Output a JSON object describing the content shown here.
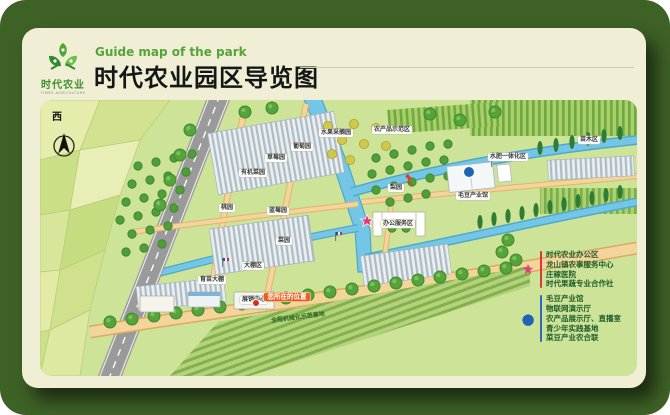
{
  "header": {
    "logo_name": "时代农业",
    "logo_sub": "TIMES AGRICULTURE",
    "subtitle": "Guide map of the park",
    "title": "时代农业园区导览图"
  },
  "compass": {
    "direction": "西"
  },
  "legend": {
    "star_items": [
      "时代农业办公区",
      "龙山镇农事服务中心",
      "庄稼医院",
      "时代果蔬专业合作社"
    ],
    "dot_items": [
      "毛豆产业馆",
      "物联网演示厅",
      "农产品展示厅、直播室",
      "青少年实践基地",
      "菜豆产业农合联"
    ]
  },
  "map": {
    "you_are_here": "您所在的位置",
    "labels": {
      "grape": "葡萄园",
      "strawberry": "草莓园",
      "organic_veg": "有机菜园",
      "fruit_picking": "水果采摘园",
      "demo_zone": "农产品示范区",
      "peach": "桃园",
      "blueberry": "蓝莓园",
      "vegetable": "菜园",
      "greenhouse": "大棚区",
      "pear": "梨园",
      "water_fert": "水肥一体化区",
      "industry_hall": "毛豆产业馆",
      "office": "办公服务区",
      "exhibition": "展销中心",
      "mechanized": "全程机械化示范基地",
      "nursery": "苗木区",
      "seedling": "育苗大棚"
    }
  },
  "colors": {
    "outer_green": "#3e6126",
    "card_cream": "#f0efd6",
    "map_green": "#cde398",
    "accent_green": "#55a33b",
    "star_pink": "#e8387d",
    "dot_blue": "#1c64b5",
    "river_blue": "#74c6e6",
    "road_gray": "#9a9a9a",
    "path_tan": "#f3d59b",
    "you_are_here_orange": "#e8611c"
  }
}
